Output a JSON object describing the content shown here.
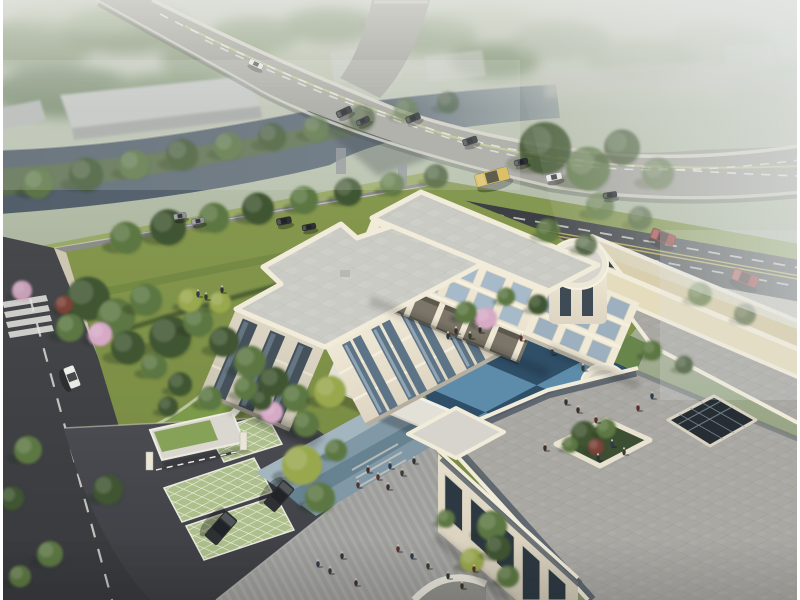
{
  "scene": {
    "description": "Aerial architectural rendering: three-storey cream courtyard building with blue checkered plaza, green-roof gatehouse, parking pads, riverside trees and a curved highway bridge with traffic in morning haze",
    "palette": {
      "sky_top": "#c9cdc3",
      "sky_mid": "#b4bdaa",
      "field": "#a9b399",
      "river": "#525e6a",
      "river_far": "#8b969e",
      "bank_tree": "#5b6f47",
      "tree_dark": "#3f5531",
      "tree_mid": "#5c7743",
      "tree_yellow": "#99a84e",
      "tree_pink": "#d6a9c5",
      "tree_red": "#7c4338",
      "shed": "#c4c6c4",
      "cube": "#caccc8",
      "bridge_deck": "#a7a6a0",
      "bridge_edge": "#d8d5cb",
      "lane_white": "#e8e8e2",
      "lane_yellow": "#c9cf8e",
      "road_dark": "#3c3f43",
      "road_dash": "#d9d9d5",
      "road_yellow": "#c7b94e",
      "avenue": "#8d8d88",
      "sidewalk": "#cdc6b2",
      "lawn": "#7f9348",
      "lawn_light": "#93a557",
      "hedge": "#42552f",
      "green_roof": "#7c9b4a",
      "lattice": "#adbf8a",
      "drive": "#46484c",
      "plaza": "#9e9e9c",
      "plaza_stripe": "#adada9",
      "pave_blue1": "#a3b5bf",
      "pave_blue2": "#8199a7",
      "pave_blue3": "#64808f",
      "court_light": "#5d8cab",
      "court_dark": "#2f4e68",
      "wall_cream": "#ece5d3",
      "wall_bright": "#f3ecd9",
      "wall_shadow": "#d9d2bf",
      "roof_grey": "#cbcbc5",
      "parapet": "#f1ebda",
      "roof_beige": "#e5dbbd",
      "roof_beige2": "#d9cfae",
      "terrace": "#a9a8a3",
      "slate_band": "#59616a",
      "glass": "#a7bac9",
      "glass_dark": "#32404b",
      "atrium": "#262d33",
      "car_dark": "#2e3134",
      "car_grey": "#8f9294",
      "car_white": "#e9e9e6",
      "car_red": "#8f2f2c",
      "bus_yellow": "#d9b84e",
      "person": "#2e3337"
    },
    "vehicles": [
      {
        "x": 256,
        "y": 64,
        "l": 15,
        "w": 6,
        "r": 24,
        "c": "car_white",
        "n": "distant-bus"
      },
      {
        "x": 344,
        "y": 112,
        "l": 16,
        "w": 7,
        "r": -25,
        "c": "car_dark",
        "n": "bridge-car"
      },
      {
        "x": 363,
        "y": 121,
        "l": 14,
        "w": 6,
        "r": -25,
        "c": "car_dark",
        "n": "bridge-car"
      },
      {
        "x": 413,
        "y": 118,
        "l": 15,
        "w": 7,
        "r": -22,
        "c": "car_dark",
        "n": "bridge-car"
      },
      {
        "x": 470,
        "y": 141,
        "l": 15,
        "w": 7,
        "r": -18,
        "c": "car_dark",
        "n": "bridge-car"
      },
      {
        "x": 521,
        "y": 162,
        "l": 14,
        "w": 6,
        "r": -14,
        "c": "car_dark",
        "n": "bridge-car"
      },
      {
        "x": 492,
        "y": 177,
        "l": 34,
        "w": 13,
        "r": -15,
        "c": "bus_yellow",
        "n": "bus"
      },
      {
        "x": 554,
        "y": 177,
        "l": 16,
        "w": 7,
        "r": -12,
        "c": "car_white",
        "n": "bridge-car-white"
      },
      {
        "x": 610,
        "y": 195,
        "l": 14,
        "w": 6,
        "r": -8,
        "c": "car_dark",
        "n": "bridge-car"
      },
      {
        "x": 663,
        "y": 237,
        "l": 25,
        "w": 11,
        "r": 21,
        "c": "car_red",
        "n": "street-car-red"
      },
      {
        "x": 745,
        "y": 278,
        "l": 27,
        "w": 12,
        "r": 21,
        "c": "car_red",
        "n": "street-car-red"
      },
      {
        "x": 284,
        "y": 221,
        "l": 15,
        "w": 7,
        "r": -11,
        "c": "car_dark",
        "n": "avenue-car"
      },
      {
        "x": 309,
        "y": 227,
        "l": 14,
        "w": 6,
        "r": -11,
        "c": "car_dark",
        "n": "avenue-car"
      },
      {
        "x": 180,
        "y": 216,
        "l": 13,
        "w": 6,
        "r": -11,
        "c": "car_grey",
        "n": "avenue-car"
      },
      {
        "x": 198,
        "y": 221,
        "l": 13,
        "w": 6,
        "r": -11,
        "c": "car_grey",
        "n": "avenue-car"
      },
      {
        "x": 72,
        "y": 377,
        "l": 22,
        "w": 11,
        "r": 69,
        "c": "car_white",
        "n": "side-street-car"
      },
      {
        "x": 221,
        "y": 528,
        "l": 33,
        "w": 16,
        "r": 131,
        "c": "car_dark",
        "n": "parked-suv"
      },
      {
        "x": 279,
        "y": 496,
        "l": 31,
        "w": 15,
        "r": 131,
        "c": "car_dark",
        "n": "parked-suv"
      }
    ],
    "trees": [
      [
        38,
        186,
        15,
        "tree_mid",
        0.9
      ],
      [
        86,
        177,
        17,
        "tree_dark",
        0.9
      ],
      [
        134,
        167,
        15,
        "tree_mid",
        0.85
      ],
      [
        182,
        157,
        16,
        "tree_dark",
        0.85
      ],
      [
        228,
        148,
        14,
        "tree_mid",
        0.8
      ],
      [
        272,
        139,
        14,
        "tree_dark",
        0.8
      ],
      [
        316,
        130,
        13,
        "tree_mid",
        0.75
      ],
      [
        362,
        120,
        13,
        "tree_dark",
        0.7
      ],
      [
        406,
        112,
        12,
        "tree_mid",
        0.65
      ],
      [
        448,
        104,
        11,
        "tree_dark",
        0.6
      ],
      [
        545,
        152,
        26,
        "tree_dark",
        0.85
      ],
      [
        588,
        172,
        22,
        "tree_mid",
        0.8
      ],
      [
        622,
        150,
        18,
        "tree_dark",
        0.7
      ],
      [
        658,
        176,
        16,
        "tree_mid",
        0.6
      ],
      [
        600,
        208,
        14,
        "tree_mid",
        0.75
      ],
      [
        640,
        220,
        12,
        "tree_dark",
        0.65
      ],
      [
        548,
        232,
        12,
        "tree_mid",
        0.9
      ],
      [
        586,
        246,
        11,
        "tree_dark",
        0.85
      ],
      [
        700,
        296,
        12,
        "tree_mid",
        0.7
      ],
      [
        745,
        316,
        11,
        "tree_dark",
        0.6
      ],
      [
        126,
        240,
        16,
        "tree_mid",
        1
      ],
      [
        168,
        230,
        18,
        "tree_dark",
        1
      ],
      [
        214,
        220,
        15,
        "tree_mid",
        1
      ],
      [
        258,
        211,
        16,
        "tree_dark",
        1
      ],
      [
        304,
        202,
        14,
        "tree_mid",
        1
      ],
      [
        348,
        194,
        14,
        "tree_dark",
        1
      ],
      [
        392,
        186,
        12,
        "tree_mid",
        0.9
      ],
      [
        436,
        178,
        12,
        "tree_dark",
        0.85
      ],
      [
        88,
        302,
        22,
        "tree_dark",
        1
      ],
      [
        116,
        320,
        19,
        "tree_mid",
        1
      ],
      [
        146,
        302,
        16,
        "tree_mid",
        1
      ],
      [
        170,
        340,
        21,
        "tree_dark",
        1
      ],
      [
        128,
        350,
        17,
        "tree_dark",
        1
      ],
      [
        198,
        324,
        15,
        "tree_mid",
        1
      ],
      [
        224,
        344,
        15,
        "tree_dark",
        1
      ],
      [
        250,
        364,
        16,
        "tree_mid",
        1
      ],
      [
        274,
        384,
        15,
        "tree_dark",
        1
      ],
      [
        296,
        400,
        14,
        "tree_mid",
        1
      ],
      [
        70,
        330,
        14,
        "tree_mid",
        1
      ],
      [
        190,
        302,
        12,
        "tree_yellow",
        1
      ],
      [
        220,
        304,
        11,
        "tree_yellow",
        1
      ],
      [
        154,
        368,
        13,
        "tree_mid",
        1
      ],
      [
        180,
        386,
        12,
        "tree_dark",
        1
      ],
      [
        210,
        400,
        12,
        "tree_mid",
        1
      ],
      [
        100,
        336,
        12,
        "tree_pink",
        1
      ],
      [
        272,
        414,
        11,
        "tree_pink",
        1
      ],
      [
        22,
        292,
        10,
        "tree_pink",
        0.9
      ],
      [
        64,
        306,
        9,
        "tree_red",
        1
      ],
      [
        486,
        320,
        11,
        "tree_pink",
        1
      ],
      [
        246,
        390,
        12,
        "tree_mid",
        1
      ],
      [
        262,
        402,
        10,
        "tree_dark",
        1
      ],
      [
        168,
        408,
        10,
        "tree_dark",
        1
      ],
      [
        108,
        492,
        15,
        "tree_dark",
        1
      ],
      [
        50,
        556,
        13,
        "tree_mid",
        1
      ],
      [
        28,
        452,
        14,
        "tree_mid",
        1
      ],
      [
        12,
        500,
        12,
        "tree_dark",
        1
      ],
      [
        20,
        578,
        11,
        "tree_mid",
        1
      ],
      [
        302,
        468,
        20,
        "tree_yellow",
        1
      ],
      [
        320,
        500,
        15,
        "tree_mid",
        1
      ],
      [
        336,
        452,
        11,
        "tree_mid",
        1
      ],
      [
        492,
        528,
        15,
        "tree_mid",
        1
      ],
      [
        472,
        562,
        12,
        "tree_yellow",
        1
      ],
      [
        508,
        578,
        11,
        "tree_mid",
        1
      ],
      [
        446,
        520,
        9,
        "tree_mid",
        1
      ],
      [
        498,
        550,
        13,
        "tree_dark",
        1
      ],
      [
        330,
        394,
        16,
        "tree_yellow",
        1
      ],
      [
        306,
        426,
        13,
        "tree_mid",
        1
      ],
      [
        466,
        314,
        11,
        "tree_mid",
        1
      ],
      [
        506,
        298,
        9,
        "tree_mid",
        1
      ],
      [
        538,
        306,
        10,
        "tree_dark",
        1
      ],
      [
        652,
        352,
        10,
        "tree_mid",
        1
      ],
      [
        684,
        366,
        9,
        "tree_dark",
        1
      ],
      [
        584,
        436,
        13,
        "tree_dark",
        1
      ],
      [
        606,
        430,
        10,
        "tree_mid",
        1
      ],
      [
        596,
        448,
        8,
        "tree_red",
        1
      ],
      [
        570,
        446,
        8,
        "tree_mid",
        1
      ]
    ],
    "people": [
      [
        448,
        336
      ],
      [
        456,
        331
      ],
      [
        521,
        338
      ],
      [
        552,
        352
      ],
      [
        583,
        368
      ],
      [
        566,
        402
      ],
      [
        578,
        410
      ],
      [
        596,
        420
      ],
      [
        612,
        444
      ],
      [
        624,
        452
      ],
      [
        598,
        458
      ],
      [
        545,
        448
      ],
      [
        638,
        408
      ],
      [
        652,
        396
      ],
      [
        470,
        336
      ],
      [
        480,
        330
      ],
      [
        368,
        470
      ],
      [
        378,
        477
      ],
      [
        390,
        466
      ],
      [
        402,
        473
      ],
      [
        414,
        461
      ],
      [
        388,
        487
      ],
      [
        358,
        485
      ],
      [
        318,
        564
      ],
      [
        330,
        571
      ],
      [
        342,
        556
      ],
      [
        356,
        583
      ],
      [
        398,
        549
      ],
      [
        412,
        556
      ],
      [
        428,
        566
      ],
      [
        448,
        576
      ],
      [
        462,
        586
      ],
      [
        474,
        569
      ],
      [
        198,
        294
      ],
      [
        206,
        297
      ],
      [
        222,
        290
      ]
    ]
  }
}
